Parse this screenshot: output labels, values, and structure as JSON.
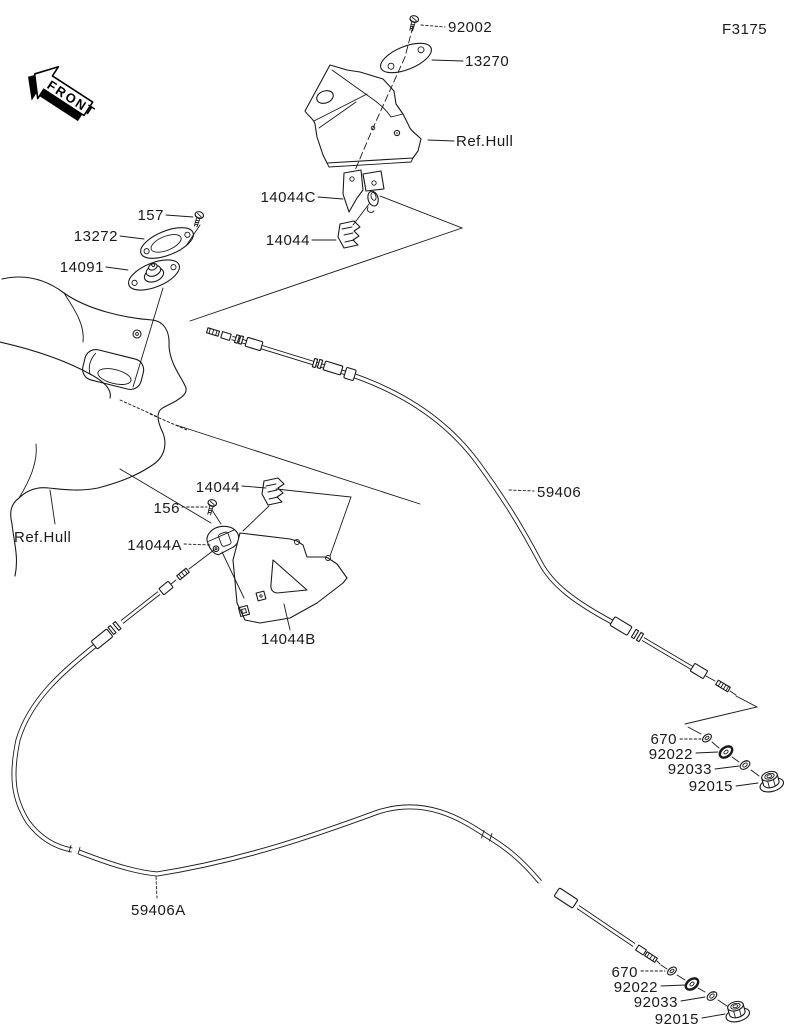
{
  "figure": {
    "code": "F3175",
    "front_label": "FRONT"
  },
  "colors": {
    "ink": "#1a1a1a",
    "background": "#ffffff"
  },
  "callouts": {
    "p92002": "92002",
    "p13270": "13270",
    "ref_hull_top": "Ref.Hull",
    "p14044C": "14044C",
    "p14044_top": "14044",
    "p157": "157",
    "p13272": "13272",
    "p14091": "14091",
    "ref_hull_left": "Ref.Hull",
    "p14044_mid": "14044",
    "p156": "156",
    "p14044A": "14044A",
    "p14044B": "14044B",
    "p59406": "59406",
    "p59406A": "59406A",
    "upper_stack": {
      "p670": "670",
      "p92022": "92022",
      "p92033": "92033",
      "p92015": "92015"
    },
    "lower_stack": {
      "p670": "670",
      "p92022": "92022",
      "p92033": "92033",
      "p92015": "92015"
    }
  }
}
